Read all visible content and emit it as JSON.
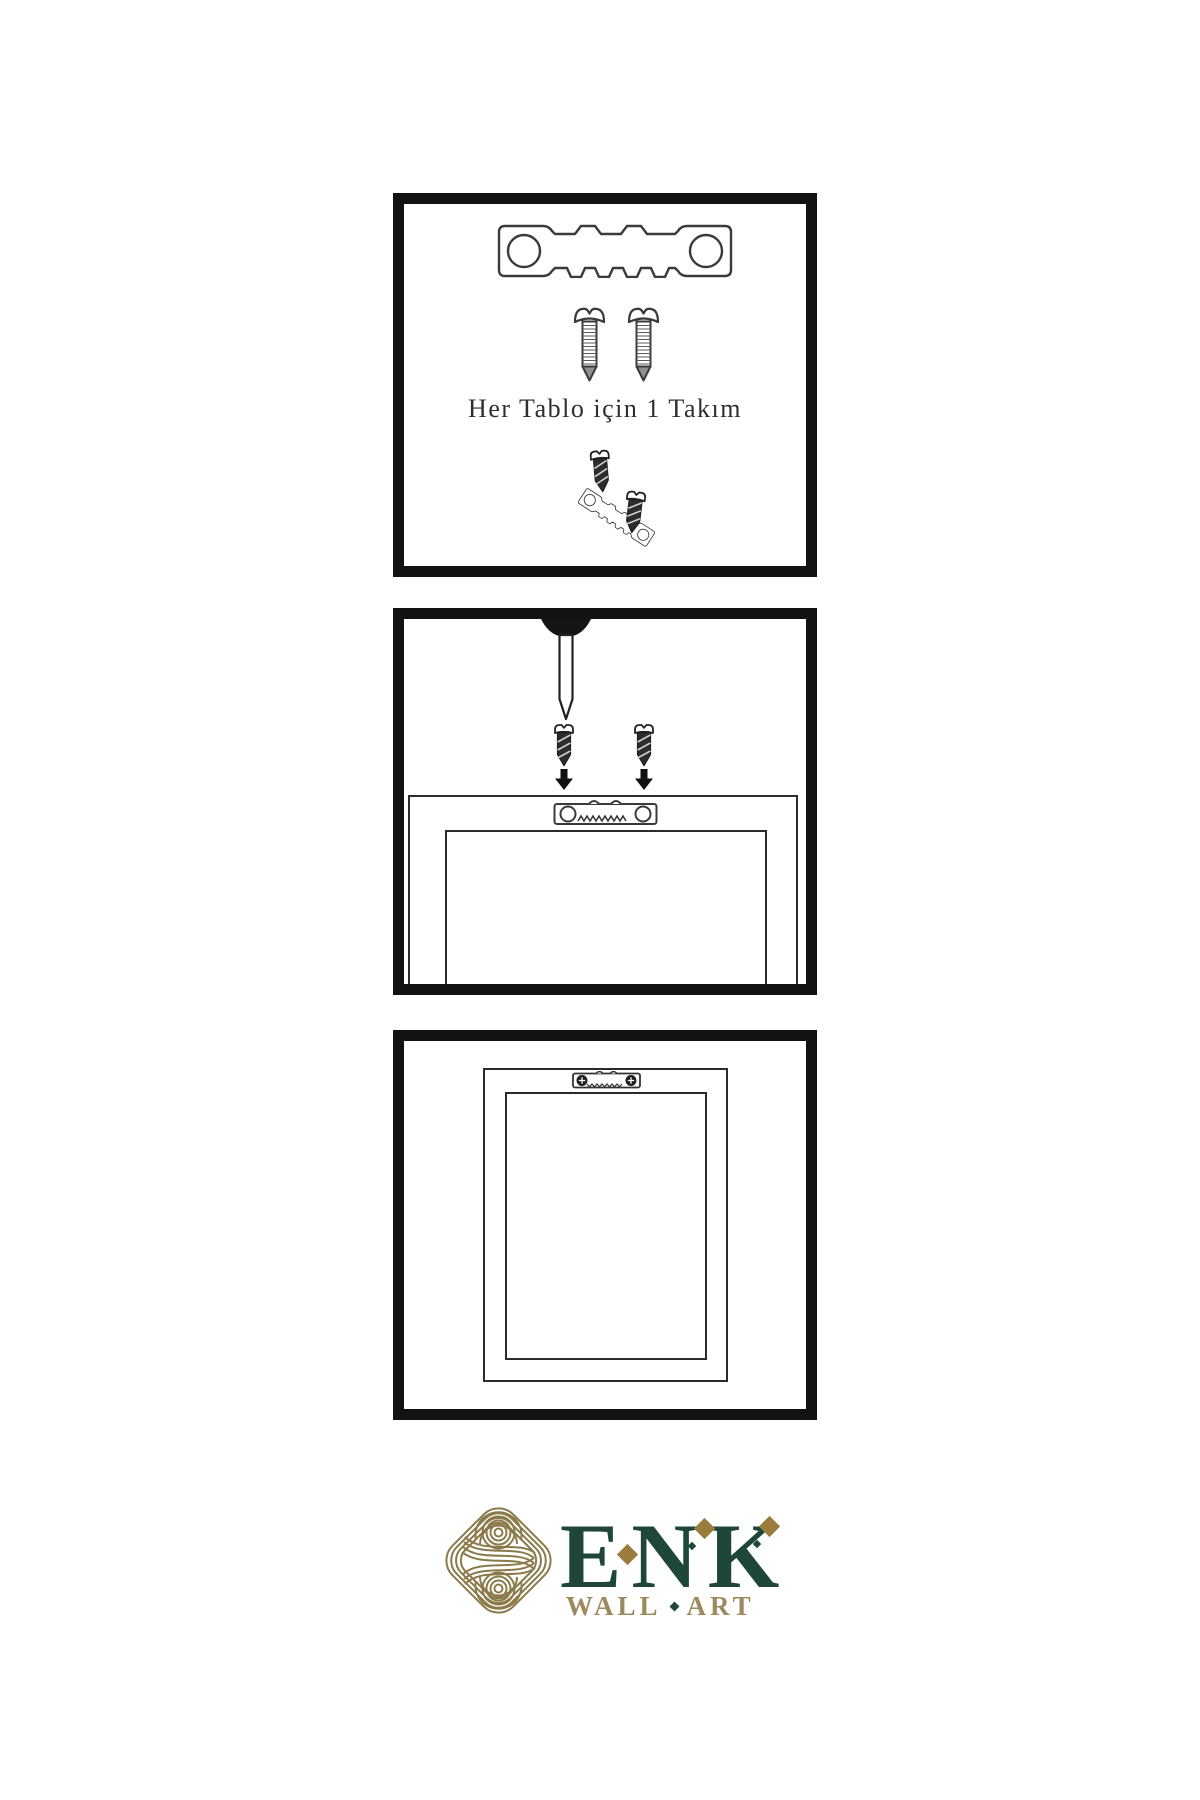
{
  "page": {
    "background": "#ffffff"
  },
  "steps": {
    "kit": {
      "caption": "Her Tablo için 1 Takım",
      "contents": [
        "sawtooth-hanger",
        "two-screws",
        "mounting-example"
      ]
    },
    "install": {
      "contents": [
        "wall-nail",
        "two-screws",
        "down-arrows",
        "frame-back-with-sawtooth-hanger"
      ]
    },
    "hang": {
      "contents": [
        "framed-picture-hung-by-sawtooth-hanger"
      ]
    }
  },
  "brand": {
    "name": "ENK",
    "tagline_words": [
      "WALL",
      "ART"
    ],
    "colors": {
      "green": "#1e4639",
      "gold": "#9a7c3c",
      "knot_gold": "#8b7a49",
      "tan": "#9c8a5e"
    }
  },
  "ink": {
    "panel_border": "#121212",
    "line_art": "#3a3a3a",
    "caption": "#2e2e2e"
  }
}
